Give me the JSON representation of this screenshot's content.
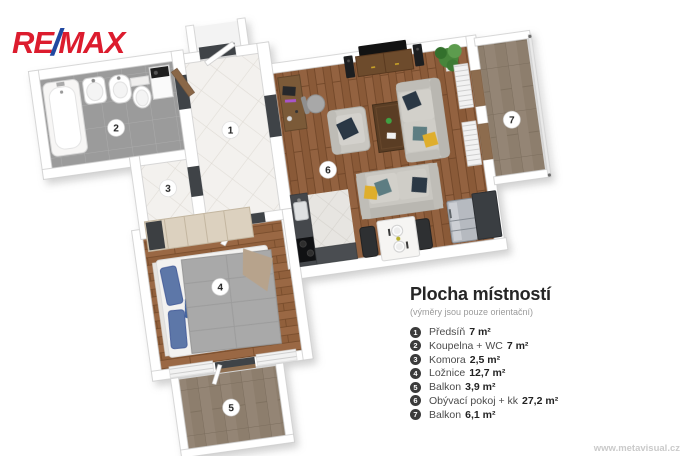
{
  "logo": {
    "re": "RE",
    "slash": "/",
    "max": "MAX"
  },
  "legend": {
    "title": "Plocha místností",
    "subtitle": "(výměry jsou pouze orientační)",
    "items": [
      {
        "num": "1",
        "label": "Předsíň",
        "area": "7 m²"
      },
      {
        "num": "2",
        "label": "Koupelna + WC",
        "area": "7 m²"
      },
      {
        "num": "3",
        "label": "Komora",
        "area": "2,5 m²"
      },
      {
        "num": "4",
        "label": "Ložnice",
        "area": "12,7 m²"
      },
      {
        "num": "5",
        "label": "Balkon",
        "area": "3,9 m²"
      },
      {
        "num": "6",
        "label": "Obývací pokoj + kk",
        "area": "27,2 m²"
      },
      {
        "num": "7",
        "label": "Balkon",
        "area": "6,1 m²"
      }
    ]
  },
  "plan": {
    "badges": [
      "1",
      "2",
      "3",
      "4",
      "5",
      "6",
      "7"
    ]
  },
  "watermark": "www.metavisual.cz",
  "colors": {
    "remax_red": "#DC1C2E",
    "remax_blue": "#2148A1",
    "legend_badge": "#3B3B3B",
    "wood_floor": "#8A5A38",
    "bath_tile": "#9B9B9B",
    "balcony_tile": "#8D7E6D",
    "wall": "#FFFFFF"
  }
}
